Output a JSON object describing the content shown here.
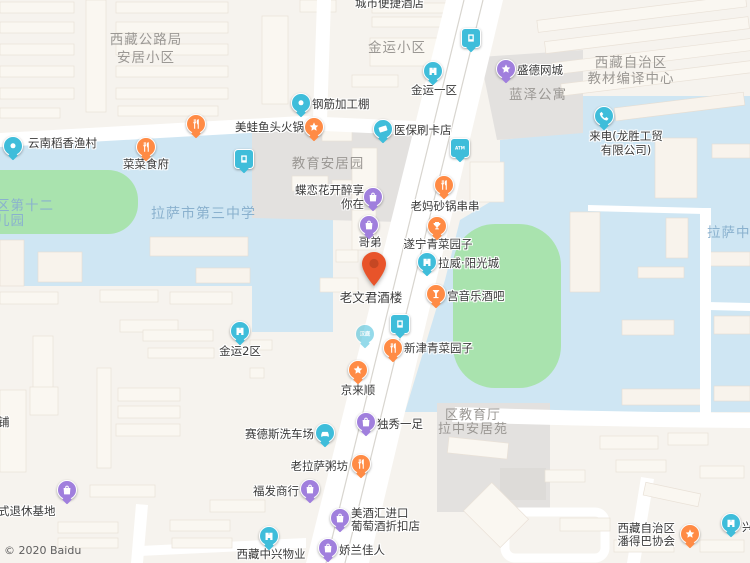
{
  "map": {
    "copyright": "© 2020 Baidu",
    "selected_poi": "老文君酒楼",
    "colors": {
      "orange": "#ff8b45",
      "teal": "#3fbdda",
      "purple": "#a07fdd",
      "selected_pin": "#e8542a",
      "area_blue": "#cfe6f3",
      "field_green": "#a9e3ae",
      "gray_block": "#e3e1df",
      "road": "#ffffff"
    },
    "area_labels": [
      {
        "id": "xizang-gonglu-ju",
        "lines": [
          "西藏公路局",
          "安居小区"
        ],
        "x": 146,
        "y": 31,
        "align": "c",
        "style": "gray",
        "lh": 18
      },
      {
        "id": "jinyun-xiaoqu",
        "lines": [
          "金运小区"
        ],
        "x": 397,
        "y": 41,
        "align": "c",
        "style": "gray"
      },
      {
        "id": "jiaoyu-anjuyuan",
        "lines": [
          "教育安居园"
        ],
        "x": 328,
        "y": 157,
        "align": "c",
        "style": "gray"
      },
      {
        "id": "jiaocai-bianyi-zhongxin",
        "lines": [
          "西藏自治区",
          "教材编译中心"
        ],
        "x": 631,
        "y": 55,
        "align": "c",
        "style": "gray",
        "lh": 16
      },
      {
        "id": "lanze-gongyu",
        "lines": [
          "蓝泽公寓"
        ],
        "x": 538,
        "y": 88,
        "align": "c",
        "style": "gray"
      },
      {
        "id": "di12-youeryuan",
        "lines": [
          "区第十二",
          "儿园"
        ],
        "x": -4,
        "y": 199,
        "align": "l",
        "style": "blue",
        "lh": 15
      },
      {
        "id": "lasa-no3-school",
        "lines": [
          "拉萨市第三中学"
        ],
        "x": 151,
        "y": 207,
        "align": "l",
        "style": "blue",
        "size": 14
      },
      {
        "id": "lasa-zhong",
        "lines": [
          "拉萨中"
        ],
        "x": 707,
        "y": 226,
        "align": "l",
        "style": "blue"
      },
      {
        "id": "qu-jiaoyuting",
        "lines": [
          "区教育厅",
          "拉中安居苑"
        ],
        "x": 473,
        "y": 409,
        "align": "c",
        "style": "gray",
        "size": 13,
        "lh": 14
      }
    ],
    "pois": [
      {
        "id": "chengshi-bianjie-hotel",
        "name": "城市便捷酒店",
        "icon": null,
        "label": {
          "lines": [
            "城市便捷酒店"
          ],
          "x": 355,
          "y": -3,
          "align": "l"
        }
      },
      {
        "id": "yunnan-daoxiang",
        "name": "云南稻香渔村",
        "icon": {
          "shape": "circle",
          "glyph": "food",
          "color": "orange",
          "cx": 196,
          "cy": 125
        },
        "label": {
          "lines": [
            "云南稻香渔村"
          ],
          "x": 28,
          "y": 137,
          "align": "l"
        }
      },
      {
        "id": "caicai-shifu",
        "name": "菜菜食府",
        "icon": {
          "shape": "circle",
          "glyph": "food",
          "color": "orange",
          "cx": 146,
          "cy": 148
        },
        "label": {
          "lines": [
            "菜菜食府"
          ],
          "x": 146,
          "y": 158,
          "align": "c"
        }
      },
      {
        "id": "edge-pin",
        "name": "",
        "icon": {
          "shape": "circle",
          "glyph": "dot",
          "color": "teal",
          "cx": 13,
          "cy": 147
        },
        "label": null
      },
      {
        "id": "stop-east-blue",
        "name": "",
        "icon": {
          "shape": "square",
          "glyph": "door",
          "color": "teal",
          "cx": 244,
          "cy": 160
        },
        "label": null
      },
      {
        "id": "meiwa-yutou",
        "name": "美蛙鱼头火锅",
        "icon": {
          "shape": "circle",
          "glyph": "star",
          "color": "orange",
          "cx": 314,
          "cy": 128
        },
        "label": {
          "lines": [
            "美蛙鱼头火锅"
          ],
          "x": 304,
          "y": 121,
          "align": "r"
        }
      },
      {
        "id": "gangjin-jiagongpeng",
        "name": "钢筋加工棚",
        "icon": {
          "shape": "circle",
          "glyph": "dot",
          "color": "teal",
          "cx": 301,
          "cy": 104
        },
        "label": {
          "lines": [
            "钢筋加工棚"
          ],
          "x": 312,
          "y": 98,
          "align": "l"
        }
      },
      {
        "id": "yibao-shuakadian",
        "name": "医保刷卡店",
        "icon": {
          "shape": "circle",
          "glyph": "card",
          "color": "teal",
          "cx": 383,
          "cy": 130
        },
        "label": {
          "lines": [
            "医保刷卡店"
          ],
          "x": 394,
          "y": 124,
          "align": "l"
        }
      },
      {
        "id": "atm",
        "name": "ATM",
        "icon": {
          "shape": "square",
          "glyph": "text",
          "text": "ATM",
          "color": "teal",
          "cx": 460,
          "cy": 149
        },
        "label": null
      },
      {
        "id": "jinyun-1qu",
        "name": "金运一区",
        "icon": {
          "shape": "circle",
          "glyph": "building",
          "color": "teal",
          "cx": 433,
          "cy": 72
        },
        "label": {
          "lines": [
            "金运一区"
          ],
          "x": 434,
          "y": 84,
          "align": "c"
        }
      },
      {
        "id": "busstop-top",
        "name": "",
        "icon": {
          "shape": "square",
          "glyph": "door",
          "color": "teal",
          "cx": 471,
          "cy": 39
        },
        "label": null
      },
      {
        "id": "shengde-wangcheng",
        "name": "盛德网城",
        "icon": {
          "shape": "circle",
          "glyph": "star",
          "color": "purple",
          "cx": 506,
          "cy": 70
        },
        "label": {
          "lines": [
            "盛德网城"
          ],
          "x": 517,
          "y": 64,
          "align": "l"
        }
      },
      {
        "id": "laidian-longsheng",
        "name": "来电(龙胜工贸有限公司)",
        "icon": {
          "shape": "circle",
          "glyph": "phone",
          "color": "teal",
          "cx": 604,
          "cy": 117
        },
        "label": {
          "lines": [
            "来电(龙胜工贸",
            "有限公司)"
          ],
          "x": 626,
          "y": 129,
          "align": "c",
          "lh": 14
        }
      },
      {
        "id": "dielianhua",
        "name": "蝶恋花开醉享你在",
        "icon": {
          "shape": "circle",
          "glyph": "bag",
          "color": "purple",
          "cx": 373,
          "cy": 198
        },
        "label": {
          "lines": [
            "蝶恋花开醉享",
            "你在"
          ],
          "x": 364,
          "y": 183,
          "align": "r",
          "lh": 14
        }
      },
      {
        "id": "laoma-shaguo",
        "name": "老妈砂锅串串",
        "icon": {
          "shape": "circle",
          "glyph": "food",
          "color": "orange",
          "cx": 444,
          "cy": 186
        },
        "label": {
          "lines": [
            "老妈砂锅串串"
          ],
          "x": 445,
          "y": 200,
          "align": "c"
        }
      },
      {
        "id": "gedi",
        "name": "哥弟",
        "icon": {
          "shape": "circle",
          "glyph": "bag",
          "color": "purple",
          "cx": 369,
          "cy": 226
        },
        "label": {
          "lines": [
            "哥弟"
          ],
          "x": 370,
          "y": 236,
          "align": "c"
        }
      },
      {
        "id": "suining-qingcai",
        "name": "遂宁青菜园子",
        "icon": {
          "shape": "circle",
          "glyph": "trophy",
          "color": "orange",
          "cx": 437,
          "cy": 227
        },
        "label": {
          "lines": [
            "遂宁青菜园子"
          ],
          "x": 438,
          "y": 238,
          "align": "c"
        }
      },
      {
        "id": "lawei-yangguangcheng",
        "name": "拉威·阳光城",
        "icon": {
          "shape": "circle",
          "glyph": "building",
          "color": "teal",
          "cx": 427,
          "cy": 263
        },
        "label": {
          "lines": [
            "拉威·阳光城"
          ],
          "x": 438,
          "y": 257,
          "align": "l"
        }
      },
      {
        "id": "laowenjun-jiulou",
        "name": "老文君酒楼",
        "icon": {
          "shape": "selected-pin",
          "color": "selected_pin",
          "cx": 374,
          "cy": 290
        },
        "label": {
          "lines": [
            "老文君酒楼"
          ],
          "x": 371,
          "y": 291,
          "align": "c",
          "size": 12.5
        }
      },
      {
        "id": "gong-yinyue-jiuba",
        "name": "宫音乐酒吧",
        "icon": {
          "shape": "circle",
          "glyph": "cocktail",
          "color": "orange",
          "cx": 436,
          "cy": 295
        },
        "label": {
          "lines": [
            "宫音乐酒吧"
          ],
          "x": 447,
          "y": 290,
          "align": "l"
        }
      },
      {
        "id": "busstop-mid",
        "name": "",
        "icon": {
          "shape": "square",
          "glyph": "door",
          "color": "teal",
          "cx": 400,
          "cy": 325
        },
        "label": null
      },
      {
        "id": "hanting-faded",
        "name": "汉庭",
        "icon": {
          "shape": "circle",
          "glyph": "text",
          "text": "汉庭",
          "color": "teal",
          "cx": 365,
          "cy": 335,
          "faded": true
        },
        "label": null
      },
      {
        "id": "xinjin-qingcai",
        "name": "新津青菜园子",
        "icon": {
          "shape": "circle",
          "glyph": "food",
          "color": "orange",
          "cx": 393,
          "cy": 349
        },
        "label": {
          "lines": [
            "新津青菜园子"
          ],
          "x": 404,
          "y": 342,
          "align": "l"
        }
      },
      {
        "id": "jinyun-2qu",
        "name": "金运2区",
        "icon": {
          "shape": "circle",
          "glyph": "building",
          "color": "teal",
          "cx": 240,
          "cy": 332
        },
        "label": {
          "lines": [
            "金运2区"
          ],
          "x": 240,
          "y": 345,
          "align": "c"
        }
      },
      {
        "id": "jinglaishun",
        "name": "京来顺",
        "icon": {
          "shape": "circle",
          "glyph": "star",
          "color": "orange",
          "cx": 358,
          "cy": 371
        },
        "label": {
          "lines": [
            "京来顺"
          ],
          "x": 358,
          "y": 384,
          "align": "c"
        }
      },
      {
        "id": "duxiu-yizu",
        "name": "独秀一足",
        "icon": {
          "shape": "circle",
          "glyph": "bag",
          "color": "purple",
          "cx": 366,
          "cy": 423
        },
        "label": {
          "lines": [
            "独秀一足"
          ],
          "x": 377,
          "y": 418,
          "align": "l"
        }
      },
      {
        "id": "saidesi-xichechang",
        "name": "赛德斯洗车场",
        "icon": {
          "shape": "circle",
          "glyph": "car",
          "color": "teal",
          "cx": 325,
          "cy": 434
        },
        "label": {
          "lines": [
            "赛德斯洗车场"
          ],
          "x": 314,
          "y": 428,
          "align": "r"
        }
      },
      {
        "id": "laolasa-zhoufang",
        "name": "老拉萨粥坊",
        "icon": {
          "shape": "circle",
          "glyph": "food",
          "color": "orange",
          "cx": 361,
          "cy": 465
        },
        "label": {
          "lines": [
            "老拉萨粥坊"
          ],
          "x": 348,
          "y": 460,
          "align": "r"
        }
      },
      {
        "id": "fufa-shanghang",
        "name": "福发商行",
        "icon": {
          "shape": "circle",
          "glyph": "bag",
          "color": "purple",
          "cx": 310,
          "cy": 490
        },
        "label": {
          "lines": [
            "福发商行"
          ],
          "x": 299,
          "y": 485,
          "align": "r"
        }
      },
      {
        "id": "meijiuhui",
        "name": "美酒汇进口葡萄酒折扣店",
        "icon": {
          "shape": "circle",
          "glyph": "bag",
          "color": "purple",
          "cx": 340,
          "cy": 519
        },
        "label": {
          "lines": [
            "美酒汇进口",
            "葡萄酒折扣店"
          ],
          "x": 351,
          "y": 507,
          "align": "l",
          "lh": 13
        }
      },
      {
        "id": "jiaolan-jiaren",
        "name": "娇兰佳人",
        "icon": {
          "shape": "circle",
          "glyph": "bag",
          "color": "purple",
          "cx": 328,
          "cy": 549
        },
        "label": {
          "lines": [
            "娇兰佳人"
          ],
          "x": 339,
          "y": 544,
          "align": "l"
        }
      },
      {
        "id": "xizang-zhongxing-wuye",
        "name": "西藏中兴物业",
        "icon": {
          "shape": "circle",
          "glyph": "building",
          "color": "teal",
          "cx": 269,
          "cy": 537
        },
        "label": {
          "lines": [
            "西藏中兴物业"
          ],
          "x": 271,
          "y": 548,
          "align": "c"
        }
      },
      {
        "id": "tuixiu-jidi",
        "name": "式退休基地",
        "icon": {
          "shape": "circle",
          "glyph": "bag",
          "color": "purple",
          "cx": 67,
          "cy": 491
        },
        "label": {
          "lines": [
            "式退休基地"
          ],
          "x": -2,
          "y": 505,
          "align": "l"
        }
      },
      {
        "id": "pu-cut",
        "name": "铺",
        "icon": null,
        "label": {
          "lines": [
            "铺"
          ],
          "x": -2,
          "y": 416,
          "align": "l"
        }
      },
      {
        "id": "pandeba-xiehui",
        "name": "西藏自治区潘得巴协会",
        "icon": {
          "shape": "circle",
          "glyph": "star",
          "color": "orange",
          "cx": 690,
          "cy": 535
        },
        "label": {
          "lines": [
            "西藏自治区",
            "潘得巴协会"
          ],
          "x": 675,
          "y": 522,
          "align": "r",
          "lh": 13
        }
      },
      {
        "id": "xing-cut",
        "name": "兴",
        "icon": {
          "shape": "circle",
          "glyph": "building",
          "color": "teal",
          "cx": 731,
          "cy": 524
        },
        "label": {
          "lines": [
            "兴"
          ],
          "x": 742,
          "y": 521,
          "align": "l"
        }
      }
    ]
  }
}
